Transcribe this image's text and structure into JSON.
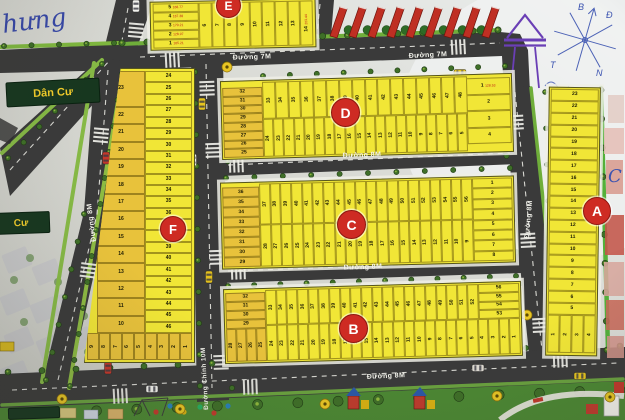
{
  "annotations": {
    "handwriting": "hưng",
    "pen_letter": "C",
    "compass": {
      "n": "B",
      "e": "Đ",
      "s": "N",
      "w": "T"
    }
  },
  "signs": {
    "residential": "Dân Cư",
    "residential_clipped": "Cư"
  },
  "roads": {
    "r7m": "Đường 7M",
    "r8m": "Đường 8M",
    "main": "Đường Chính 10M"
  },
  "badges": {
    "a": "A",
    "b": "B",
    "c": "C",
    "d": "D",
    "e": "E",
    "f": "F"
  },
  "blocks": {
    "e": {
      "stack": [
        "5|168.77",
        "4|187.38",
        "3|170.21",
        "2|128.97",
        "1|105.21"
      ],
      "strips": [
        "6",
        "7",
        "8",
        "9",
        "10",
        "11",
        "12",
        "13",
        "14|203.44"
      ]
    },
    "d": {
      "stack_left": [
        "32",
        "31",
        "30",
        "29",
        "28",
        "27",
        "26",
        "25"
      ],
      "top": [
        "33",
        "34",
        "35",
        "36",
        "37",
        "38",
        "39",
        "40",
        "41",
        "42",
        "43",
        "44",
        "45",
        "46",
        "47",
        "48"
      ],
      "bottom": [
        "24",
        "23",
        "22",
        "21",
        "20",
        "19",
        "18",
        "17",
        "16",
        "15",
        "14",
        "13",
        "12",
        "11",
        "10",
        "9",
        "8",
        "7",
        "6",
        "5"
      ],
      "stack_right": [
        "1|128.53",
        "2",
        "3",
        "4"
      ]
    },
    "c": {
      "stack_left": [
        "36",
        "35",
        "34",
        "33",
        "32",
        "31",
        "30",
        "29"
      ],
      "top": [
        "37",
        "38",
        "39",
        "40",
        "41",
        "42",
        "43",
        "44",
        "45",
        "46",
        "47",
        "48",
        "49",
        "50",
        "51",
        "52",
        "53",
        "54",
        "55",
        "56"
      ],
      "bottom": [
        "28",
        "27",
        "26",
        "25",
        "24",
        "23",
        "22",
        "21",
        "20",
        "19",
        "18",
        "17",
        "16",
        "15",
        "14",
        "13",
        "12",
        "11",
        "10",
        "9"
      ],
      "stack_right": [
        "1",
        "2",
        "3",
        "4",
        "5",
        "6",
        "7",
        "8"
      ]
    },
    "b": {
      "stack_left": [
        "32",
        "31",
        "30",
        "29"
      ],
      "left_bottom": [
        "28",
        "27",
        "26",
        "25"
      ],
      "top": [
        "33",
        "34",
        "35",
        "36",
        "37",
        "38",
        "39",
        "40",
        "41",
        "42",
        "43",
        "44",
        "45",
        "46",
        "47",
        "48",
        "49",
        "50",
        "51",
        "52"
      ],
      "bottom": [
        "24",
        "23",
        "22",
        "21",
        "20",
        "19",
        "18",
        "17",
        "16",
        "15",
        "14",
        "13",
        "12",
        "11",
        "10",
        "9",
        "8",
        "7",
        "6",
        "5",
        "4",
        "3",
        "2",
        "1"
      ],
      "stack_right": [
        "56",
        "55",
        "54",
        "53"
      ]
    },
    "f": {
      "left": [
        "23",
        "22",
        "21",
        "20",
        "19",
        "18",
        "17",
        "16",
        "15",
        "14",
        "13",
        "12",
        "11",
        "10"
      ],
      "right": [
        "24",
        "25",
        "26",
        "27",
        "28",
        "29",
        "30",
        "31",
        "32",
        "33",
        "34",
        "35",
        "36",
        "37",
        "38",
        "39",
        "40",
        "41",
        "42",
        "43",
        "44",
        "45",
        "46"
      ],
      "bottom": [
        "9",
        "8",
        "7",
        "6",
        "5",
        "4",
        "3",
        "2",
        "1"
      ]
    },
    "a": {
      "col": [
        "23",
        "22",
        "21",
        "20",
        "19",
        "18",
        "17",
        "16",
        "15",
        "14",
        "13",
        "12",
        "11",
        "10",
        "9",
        "8",
        "7",
        "6",
        "5"
      ],
      "bottom": [
        "1",
        "2",
        "3",
        "4"
      ]
    }
  }
}
